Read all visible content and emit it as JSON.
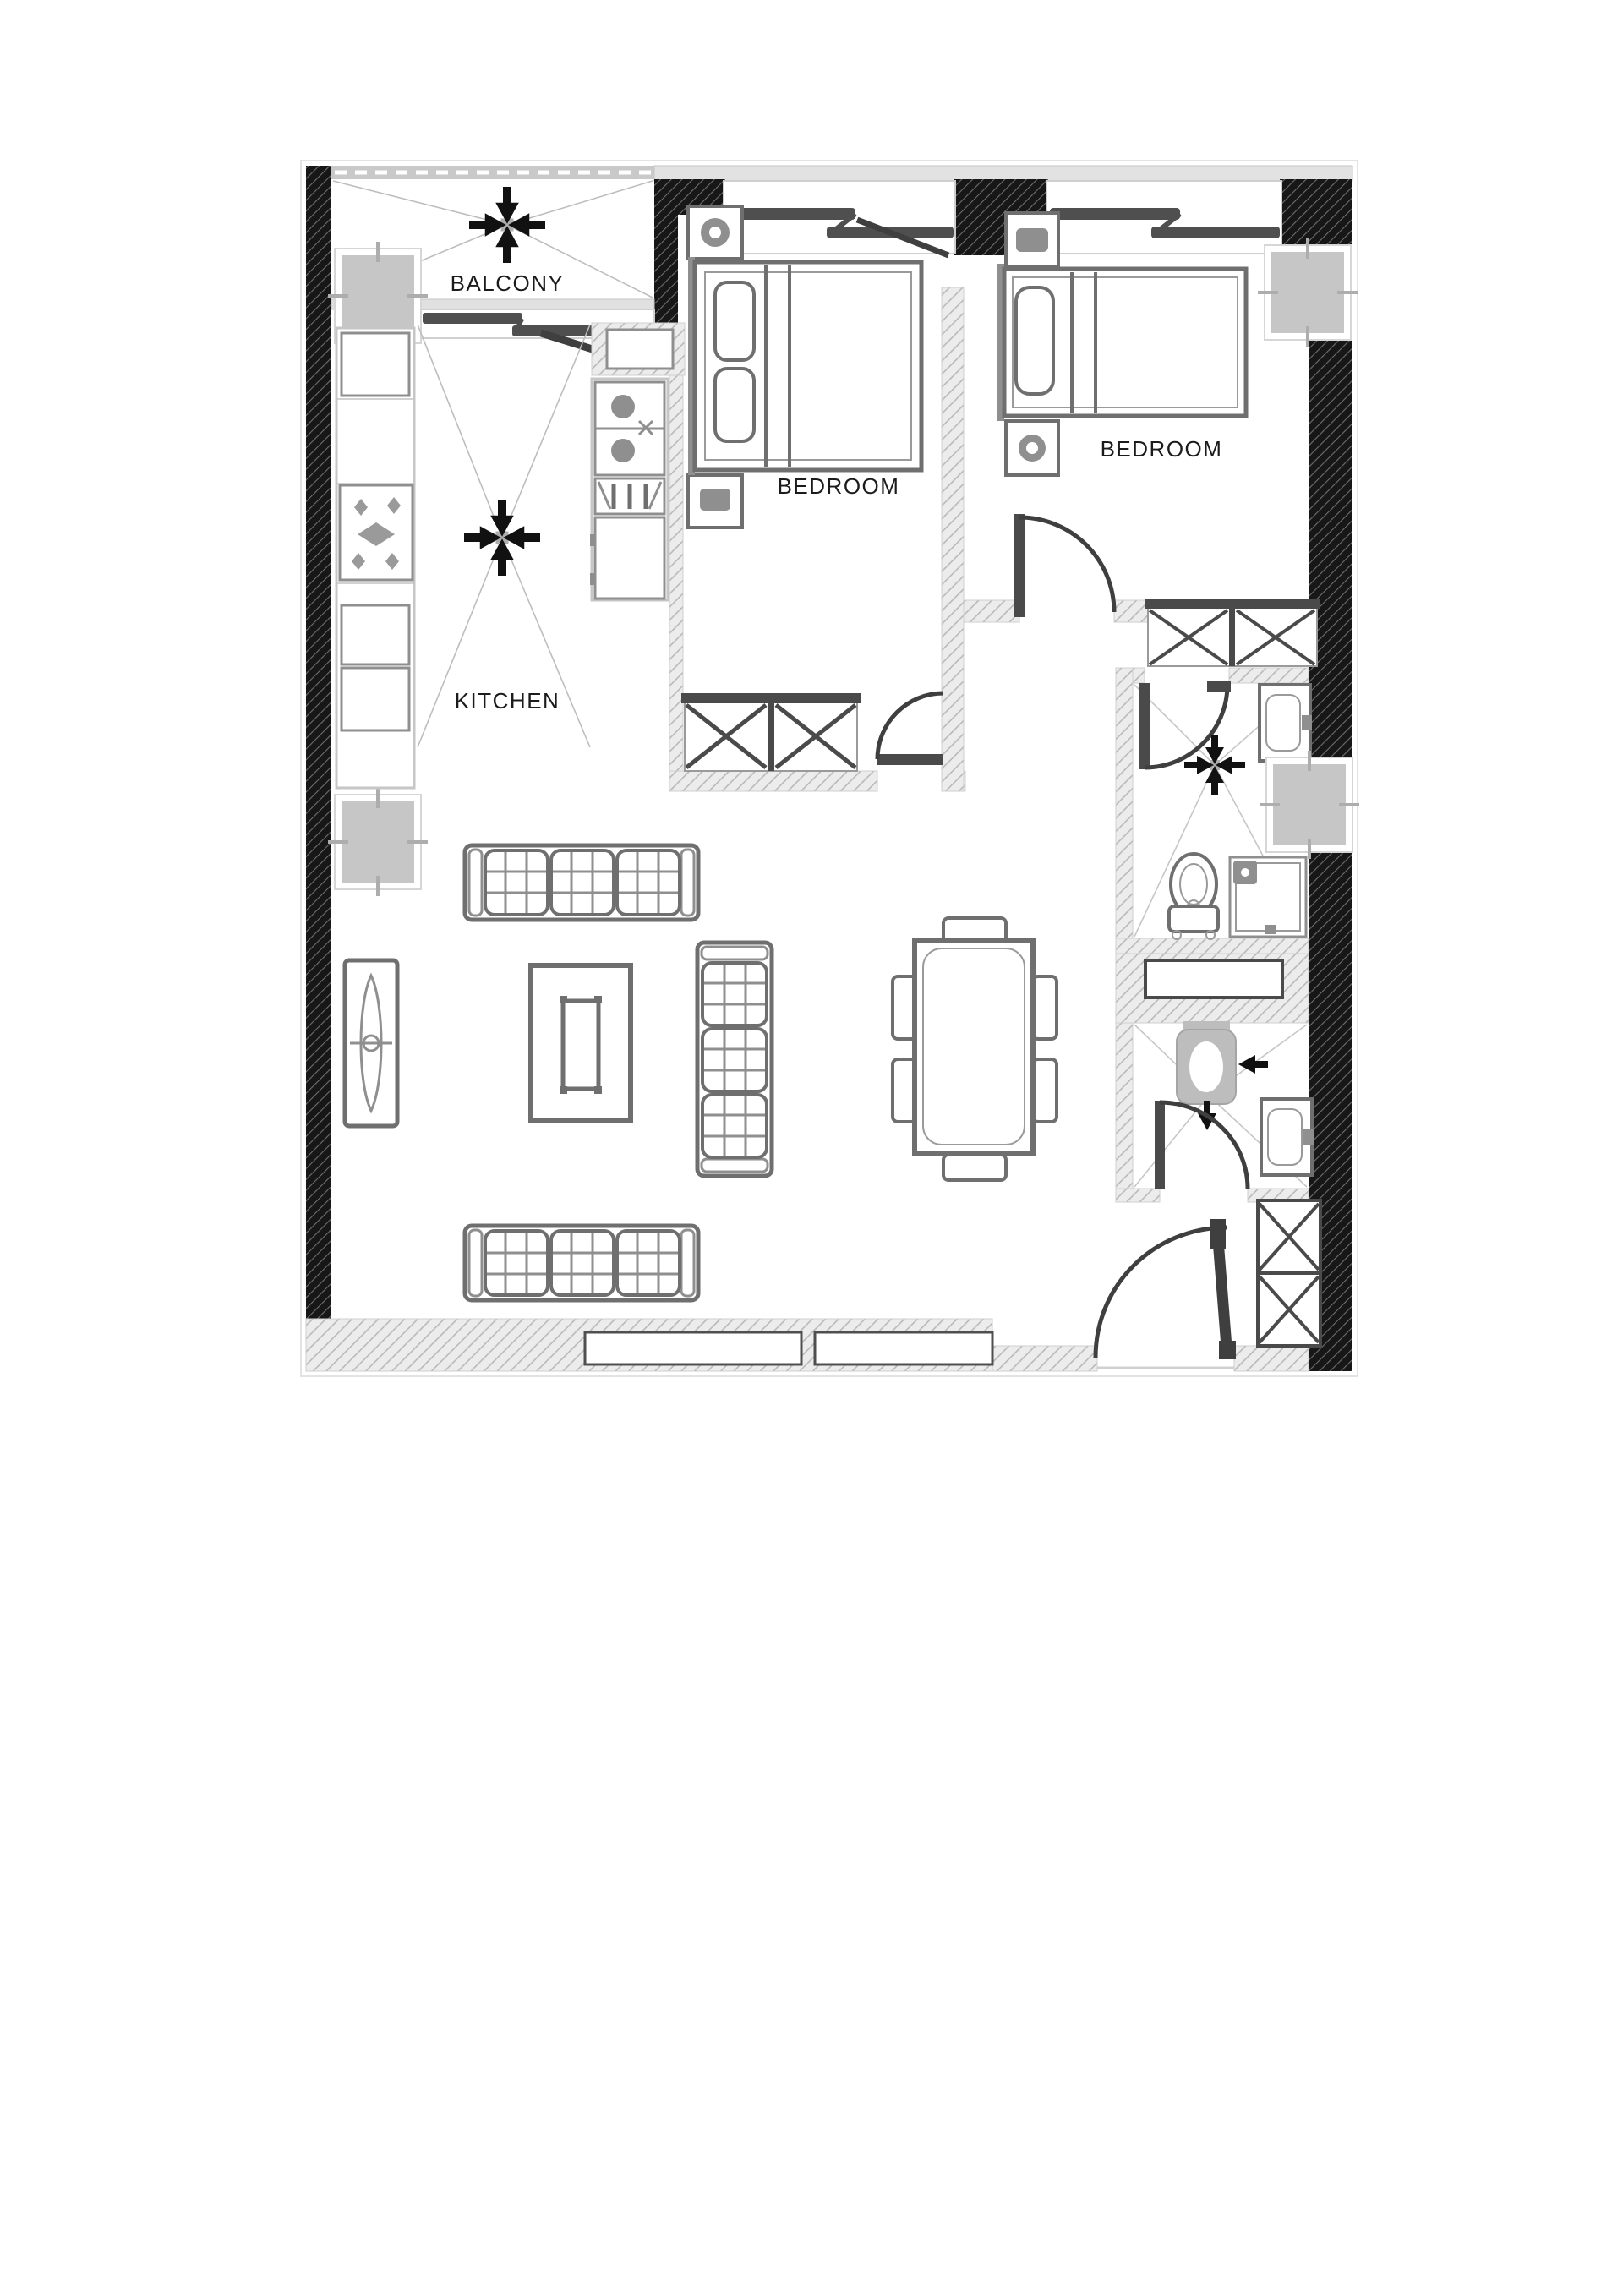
{
  "plan": {
    "labels": {
      "balcony": "BALCONY",
      "kitchen": "KITCHEN",
      "bedroom_1": "BEDROOM",
      "bedroom_2": "BEDROOM"
    },
    "colors": {
      "wall_dark": "#171717",
      "wall_dark_hatch": "#6e6e6e",
      "wall_light": "#ececec",
      "wall_light_hatch": "#b9b9b9",
      "furniture": "#6f6f6f",
      "furniture_dark": "#4a4a4a",
      "fixture_gray": "#c6c6c6",
      "symbol_black": "#111111",
      "label_text": "#1b1b1b",
      "floor": "#ffffff"
    },
    "symbols": [
      {
        "name": "ceiling-fan-icon",
        "room": "balcony"
      },
      {
        "name": "ceiling-fan-icon",
        "room": "kitchen"
      },
      {
        "name": "exhaust-fan-icon",
        "room": "bathroom-1"
      },
      {
        "name": "exhaust-arrow-left-icon",
        "room": "bathroom-2"
      },
      {
        "name": "exhaust-arrow-down-icon",
        "room": "bathroom-2"
      }
    ]
  }
}
